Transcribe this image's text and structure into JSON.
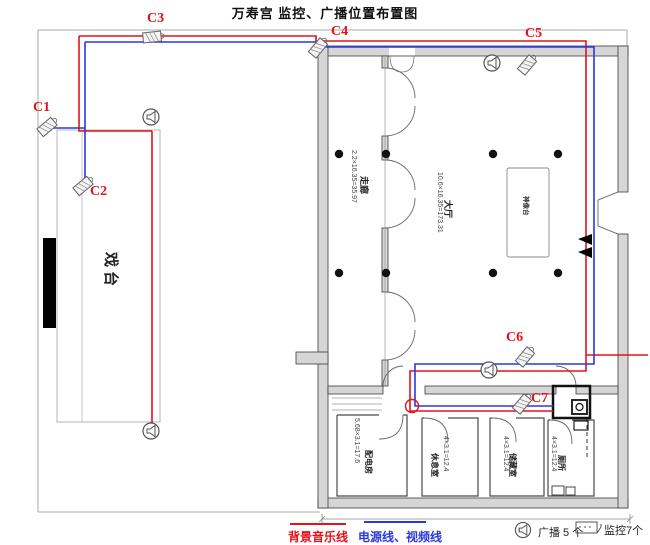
{
  "title": "万寿宫 监控、广播位置布置图",
  "colors": {
    "music_line": "#e41219",
    "power_video_line": "#2b38dd"
  },
  "cameras": [
    "C1",
    "C2",
    "C3",
    "C4",
    "C5",
    "C6",
    "C7"
  ],
  "rooms": {
    "stage": {
      "name": "戏台"
    },
    "corridor": {
      "name": "走廊",
      "dims": "2.2×16.35=35.97"
    },
    "hall": {
      "name": "大厅",
      "dims": "10.6×16.35=173.31"
    },
    "altar": {
      "name": "神像台"
    },
    "power_room": {
      "name": "配电房",
      "dims": "5.68×3.1=17.6"
    },
    "rest_room": {
      "name": "休息室",
      "dims": "4×3.1=12.4"
    },
    "storage_room": {
      "name": "储藏室",
      "dims": "4×3.1=12.4"
    },
    "toilet": {
      "name": "厕所",
      "dims": "4×3.1=12.4"
    }
  },
  "legend": {
    "music_line": {
      "label": "背景音乐线"
    },
    "power_video_line": {
      "label": "电源线、视频线"
    },
    "broadcast": {
      "label": "广播 5 个",
      "count": 5
    },
    "monitor": {
      "label": "监控7个",
      "count": 7
    }
  },
  "icons": {
    "camera": "cctv-camera",
    "speaker": "broadcast-speaker",
    "monitor": "monitor-screen"
  }
}
